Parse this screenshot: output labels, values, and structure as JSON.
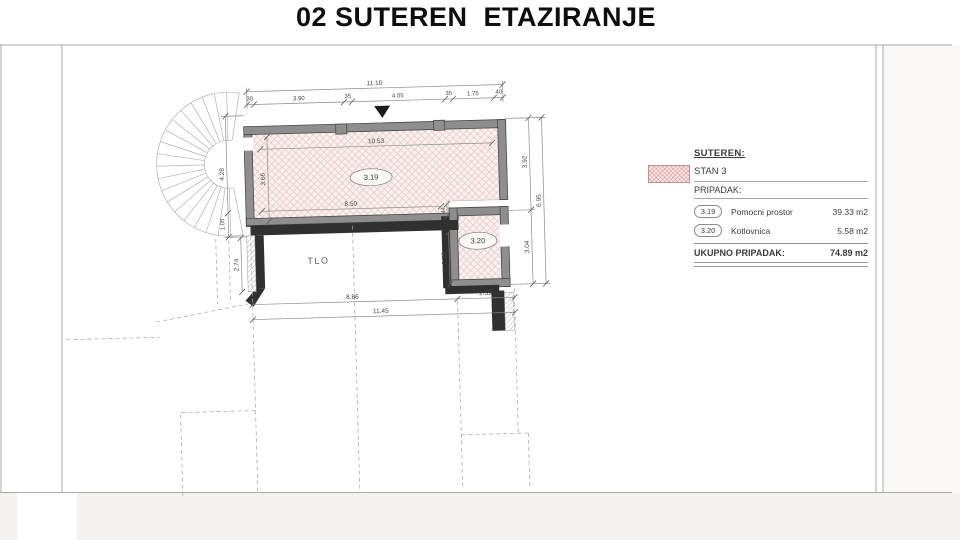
{
  "title": "02 SUTEREN  ETAZIRANJE",
  "plan": {
    "room_319_label": "3.19",
    "room_320_label": "3.20",
    "tlo_label": "TLO",
    "dims": {
      "top_total": "11.10",
      "top_segments": [
        "30",
        "3.90",
        "35",
        "4.05",
        "35",
        "1.75",
        "40"
      ],
      "inner_top": "10.53",
      "inner_left": "3.66",
      "inner_bottom": "8.50",
      "gap": "44",
      "right_upper": "3.92",
      "right_total": "6.95",
      "right_lower": "3.04",
      "left_upper": "4.28",
      "left_mid": "1.05",
      "left_lower": "2.74",
      "room2_height": "2.75",
      "bottom_left": "8.86",
      "bottom_right": "2.59",
      "bottom_total": "11.45"
    }
  },
  "legend": {
    "heading": "SUTEREN:",
    "stan": "STAN 3",
    "pripadak": "PRIPADAK:",
    "rows": [
      {
        "code": "3.19",
        "name": "Pomocni prostor",
        "area": "39.33 m2"
      },
      {
        "code": "3.20",
        "name": "Kotlovnica",
        "area": "5.58 m2"
      }
    ],
    "total_label": "UKUPNO PRIPADAK:",
    "total_value": "74.89 m2"
  },
  "colors": {
    "room_hatch_fill": "#fbf0f0",
    "room_hatch_line": "#e6c9c9",
    "wall_gray": "#8e8e8e",
    "wall_dark": "#303030"
  }
}
